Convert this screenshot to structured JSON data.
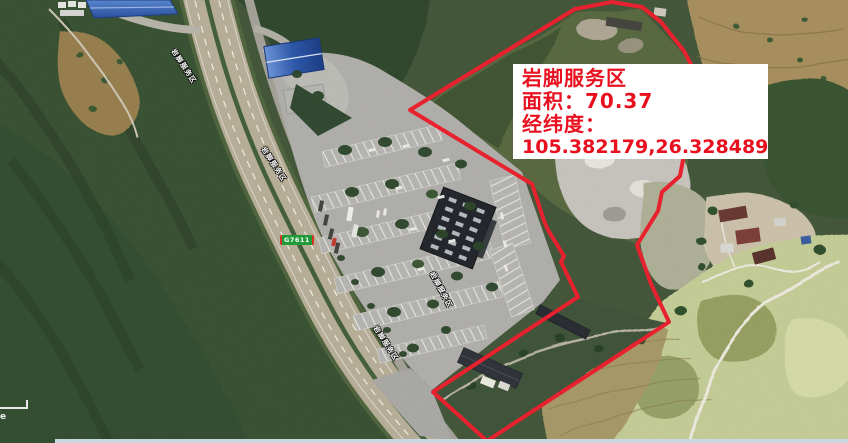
{
  "info_box": {
    "title": "岩脚服务区",
    "area_label": "面积：",
    "area_value": "70.37",
    "coord_label": "经纬度：",
    "coord_value": "105.382179,26.328489"
  },
  "map_labels": {
    "expressway_shield": "G7611",
    "service_area": "岩脚服务区"
  },
  "scale_bar": {
    "partial_text": "e"
  },
  "theme": {
    "boundary-red": "#e8212e",
    "label-red": "#e8101f",
    "shield-green": "#1f9b38",
    "strip-blue": "#ccd7e0",
    "box-bg": "#ffffff"
  }
}
